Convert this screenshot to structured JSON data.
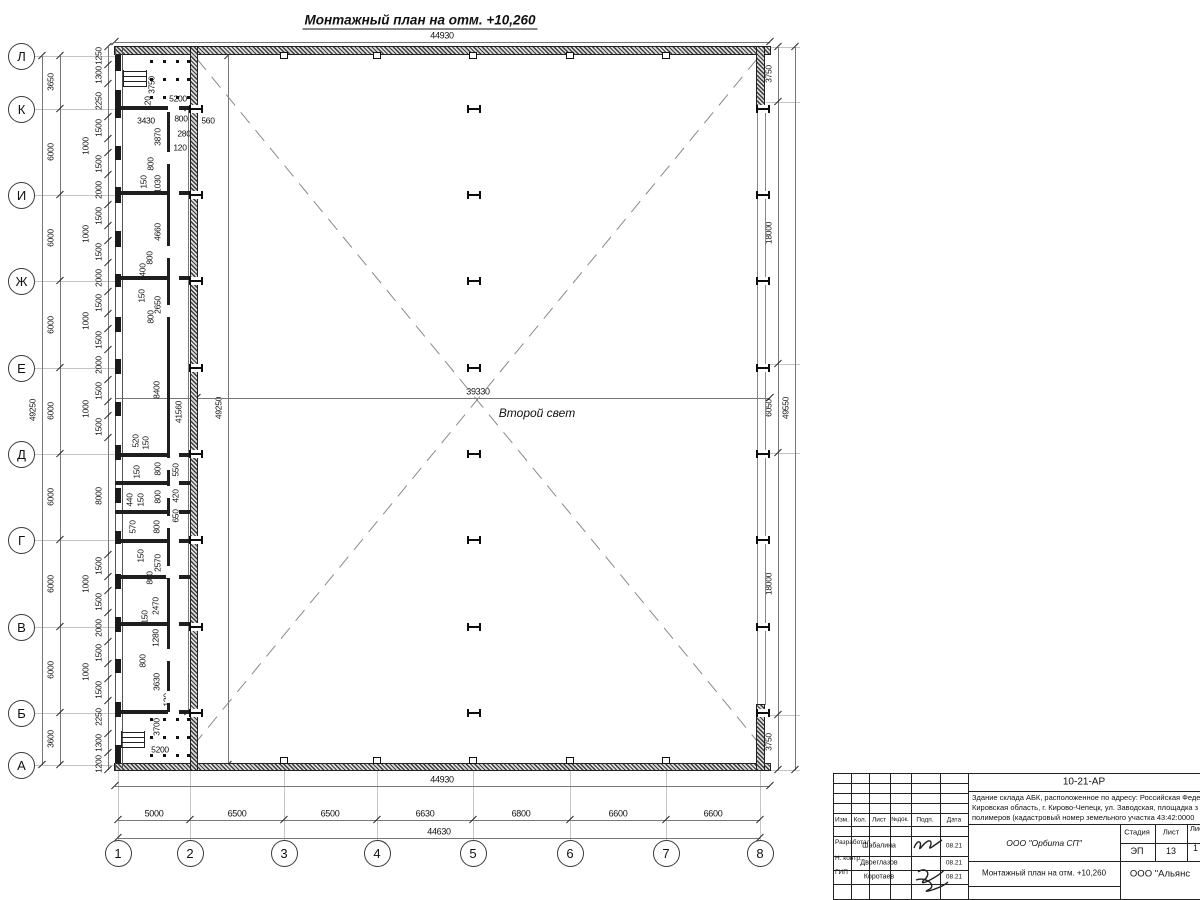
{
  "sheet": {
    "title": "Монтажный план на отм. +10,260",
    "second_light_label": "Второй свет"
  },
  "axis_rows": [
    [
      "Л",
      56
    ],
    [
      "К",
      109
    ],
    [
      "И",
      195
    ],
    [
      "Ж",
      281
    ],
    [
      "Е",
      368
    ],
    [
      "Д",
      454
    ],
    [
      "Г",
      540
    ],
    [
      "В",
      627
    ],
    [
      "Б",
      713
    ],
    [
      "А",
      765
    ]
  ],
  "axis_cols": [
    [
      "1",
      118
    ],
    [
      "2",
      190
    ],
    [
      "3",
      284
    ],
    [
      "4",
      377
    ],
    [
      "5",
      473
    ],
    [
      "6",
      570
    ],
    [
      "7",
      666
    ],
    [
      "8",
      760
    ]
  ],
  "chains": [
    {
      "o": "v",
      "p": 42,
      "a": 56,
      "b": 765,
      "t": [
        56,
        765
      ],
      "l": [
        [
          "49250",
          410,
          0
        ]
      ]
    },
    {
      "o": "v",
      "p": 60,
      "a": 56,
      "b": 765,
      "t": [
        56,
        109,
        195,
        281,
        368,
        454,
        540,
        627,
        713,
        765
      ],
      "l": [
        [
          "3650",
          82,
          0
        ],
        [
          "6000",
          152,
          0
        ],
        [
          "6000",
          238,
          0
        ],
        [
          "6000",
          325,
          0
        ],
        [
          "6000",
          411,
          0
        ],
        [
          "6000",
          497,
          0
        ],
        [
          "6000",
          584,
          0
        ],
        [
          "6000",
          670,
          0
        ],
        [
          "3600",
          739,
          0
        ]
      ]
    },
    {
      "o": "v",
      "p": 108,
      "a": 47,
      "b": 770,
      "t": [
        47,
        65,
        84,
        117,
        139,
        153,
        175,
        205,
        226,
        241,
        263,
        292,
        314,
        329,
        350,
        380,
        402,
        416,
        438,
        555,
        577,
        591,
        613,
        642,
        664,
        679,
        701,
        734,
        753,
        770
      ],
      "l": [
        [
          "1250",
          56,
          0
        ],
        [
          "1300",
          75,
          0
        ],
        [
          "2250",
          101,
          0
        ],
        [
          "1500",
          128,
          0
        ],
        [
          "1000",
          146,
          1
        ],
        [
          "1500",
          164,
          0
        ],
        [
          "2000",
          190,
          0
        ],
        [
          "1500",
          216,
          0
        ],
        [
          "1000",
          234,
          1
        ],
        [
          "1500",
          252,
          0
        ],
        [
          "2000",
          278,
          0
        ],
        [
          "1500",
          303,
          0
        ],
        [
          "1000",
          321,
          1
        ],
        [
          "1500",
          340,
          0
        ],
        [
          "2000",
          365,
          0
        ],
        [
          "1500",
          391,
          0
        ],
        [
          "1000",
          409,
          1
        ],
        [
          "1500",
          427,
          0
        ],
        [
          "8000",
          496,
          0
        ],
        [
          "1500",
          566,
          0
        ],
        [
          "1000",
          584,
          1
        ],
        [
          "1500",
          602,
          0
        ],
        [
          "2000",
          628,
          0
        ],
        [
          "1500",
          653,
          0
        ],
        [
          "1000",
          672,
          1
        ],
        [
          "1500",
          690,
          0
        ],
        [
          "2250",
          717,
          0
        ],
        [
          "1300",
          743,
          0
        ],
        [
          "1200",
          764,
          0
        ]
      ]
    },
    {
      "o": "v",
      "p": 778,
      "a": 47,
      "b": 770,
      "t": [
        47,
        102,
        364,
        453,
        715,
        770
      ],
      "l": [
        [
          "3750",
          74,
          0
        ],
        [
          "18000",
          233,
          0
        ],
        [
          "6050",
          408,
          0
        ],
        [
          "18000",
          584,
          0
        ],
        [
          "3750",
          742,
          0
        ]
      ]
    },
    {
      "o": "v",
      "p": 795,
      "a": 47,
      "b": 770,
      "t": [
        47,
        770
      ],
      "l": [
        [
          "49550",
          408,
          0
        ]
      ]
    },
    {
      "o": "h",
      "p": 42,
      "a": 115,
      "b": 770,
      "t": [
        115,
        770
      ],
      "l": [
        [
          "44930",
          442,
          0
        ]
      ]
    },
    {
      "o": "h",
      "p": 786,
      "a": 115,
      "b": 770,
      "t": [
        115,
        770
      ],
      "l": [
        [
          "44930",
          442,
          0
        ]
      ]
    },
    {
      "o": "h",
      "p": 820,
      "a": 118,
      "b": 760,
      "t": [
        118,
        190,
        284,
        377,
        473,
        570,
        666,
        760
      ],
      "l": [
        [
          "5000",
          154,
          0
        ],
        [
          "6500",
          237,
          0
        ],
        [
          "6500",
          330,
          0
        ],
        [
          "6630",
          425,
          0
        ],
        [
          "6800",
          521,
          0
        ],
        [
          "6600",
          618,
          0
        ],
        [
          "6600",
          713,
          0
        ]
      ]
    },
    {
      "o": "h",
      "p": 838,
      "a": 118,
      "b": 760,
      "t": [
        118,
        760
      ],
      "l": [
        [
          "44630",
          439,
          0
        ]
      ]
    },
    {
      "o": "v",
      "p": 188,
      "a": 108,
      "b": 712,
      "t": [
        108,
        712
      ],
      "l": [
        [
          "41560",
          412,
          0
        ]
      ]
    },
    {
      "o": "v",
      "p": 228,
      "a": 56,
      "b": 765,
      "t": [
        56,
        765
      ],
      "l": [
        [
          "49250",
          408,
          0
        ]
      ]
    },
    {
      "o": "h",
      "p": 398,
      "a": 115,
      "b": 770,
      "t": [
        197,
        770
      ],
      "l": [
        [
          "39330",
          478,
          0
        ]
      ]
    }
  ],
  "labels": [
    [
      "5200",
      178,
      99,
      0
    ],
    [
      "3750",
      152,
      85,
      1
    ],
    [
      "120",
      148,
      103,
      1
    ],
    [
      "3430",
      146,
      121,
      0
    ],
    [
      "800",
      181,
      119,
      0
    ],
    [
      "560",
      208,
      121,
      0
    ],
    [
      "280",
      184,
      134,
      0
    ],
    [
      "120",
      180,
      148,
      0
    ],
    [
      "3870",
      158,
      137,
      1
    ],
    [
      "800",
      151,
      164,
      1
    ],
    [
      "150",
      144,
      182,
      1
    ],
    [
      "1030",
      158,
      184,
      1
    ],
    [
      "4660",
      158,
      232,
      1
    ],
    [
      "800",
      150,
      258,
      1
    ],
    [
      "400",
      143,
      270,
      1
    ],
    [
      "150",
      142,
      296,
      1
    ],
    [
      "2650",
      158,
      305,
      1
    ],
    [
      "800",
      151,
      317,
      1
    ],
    [
      "8400",
      157,
      390,
      1
    ],
    [
      "520",
      136,
      441,
      1
    ],
    [
      "150",
      146,
      443,
      1
    ],
    [
      "150",
      137,
      472,
      1
    ],
    [
      "800",
      158,
      469,
      1
    ],
    [
      "550",
      176,
      470,
      1
    ],
    [
      "440",
      130,
      500,
      1
    ],
    [
      "150",
      141,
      500,
      1
    ],
    [
      "800",
      158,
      497,
      1
    ],
    [
      "420",
      176,
      496,
      1
    ],
    [
      "570",
      133,
      527,
      1
    ],
    [
      "800",
      157,
      527,
      1
    ],
    [
      "650",
      176,
      516,
      1
    ],
    [
      "150",
      141,
      556,
      1
    ],
    [
      "2570",
      158,
      563,
      1
    ],
    [
      "800",
      150,
      578,
      1
    ],
    [
      "2470",
      156,
      606,
      1
    ],
    [
      "150",
      145,
      617,
      1
    ],
    [
      "1280",
      156,
      638,
      1
    ],
    [
      "800",
      143,
      661,
      1
    ],
    [
      "3630",
      157,
      682,
      1
    ],
    [
      "120",
      167,
      700,
      1
    ],
    [
      "3700",
      157,
      727,
      1
    ],
    [
      "5200",
      160,
      750,
      0
    ]
  ],
  "partitions": [
    108,
    193,
    278,
    455,
    483,
    512,
    541,
    577,
    624,
    712
  ],
  "piers": [
    [
      55,
      16
    ],
    [
      90,
      28
    ],
    [
      146,
      14
    ],
    [
      187,
      16
    ],
    [
      231,
      16
    ],
    [
      274,
      13
    ],
    [
      317,
      15
    ],
    [
      359,
      15
    ],
    [
      402,
      14
    ],
    [
      445,
      15
    ],
    [
      488,
      15
    ],
    [
      531,
      13
    ],
    [
      574,
      15
    ],
    [
      617,
      15
    ],
    [
      659,
      14
    ],
    [
      702,
      15
    ],
    [
      745,
      18
    ]
  ],
  "corridor_gaps": [
    158,
    252,
    311,
    464,
    492,
    522,
    572,
    655,
    697
  ],
  "hcols": {
    "xs": [
      194,
      472,
      761
    ],
    "ys": [
      109,
      195,
      281,
      368,
      454,
      540,
      627,
      713
    ]
  },
  "squares": {
    "xs": [
      284,
      377,
      473,
      570,
      666
    ],
    "ytop": 52,
    "ybot": 757
  },
  "dots": {
    "xs": [
      150,
      163,
      176,
      187
    ],
    "ys_top": [
      60,
      78,
      96
    ],
    "ys_bot": [
      718,
      736,
      754
    ]
  },
  "stairs": [
    [
      123,
      70
    ],
    [
      121,
      731
    ]
  ],
  "ext_right": [
    47,
    102,
    364,
    453,
    715,
    770
  ],
  "titleblock": {
    "vlines": [
      [
        833,
        773,
        899
      ],
      [
        851,
        773,
        899
      ],
      [
        869,
        773,
        899
      ],
      [
        890,
        773,
        899
      ],
      [
        911,
        773,
        899
      ],
      [
        940,
        773,
        899
      ],
      [
        968,
        773,
        899
      ],
      [
        1120,
        824,
        899
      ],
      [
        1155,
        824,
        861
      ],
      [
        1187,
        824,
        861
      ]
    ],
    "hlines": [
      [
        773,
        833,
        1200
      ],
      [
        783,
        833,
        968
      ],
      [
        793,
        833,
        968
      ],
      [
        803,
        833,
        968
      ],
      [
        813,
        833,
        968
      ],
      [
        826,
        833,
        968
      ],
      [
        836,
        833,
        968
      ],
      [
        856,
        833,
        968
      ],
      [
        870,
        833,
        968
      ],
      [
        884,
        833,
        968
      ],
      [
        899,
        833,
        1200
      ],
      [
        791,
        968,
        1200
      ],
      [
        824,
        968,
        1200
      ],
      [
        843,
        1120,
        1200
      ],
      [
        861,
        968,
        1200
      ],
      [
        886,
        968,
        1120
      ]
    ],
    "texts": [
      {
        "t": "10-21-АР",
        "x": 1084,
        "y": 782,
        "s": 10,
        "c": 1
      },
      {
        "t": "Здание склада АБК, расположенное по адресу: Российская Феде",
        "x": 972,
        "y": 797,
        "s": 7.5
      },
      {
        "t": "Кировская область, г. Кирово-Чепецк, ул. Заводская, площадка з",
        "x": 972,
        "y": 807,
        "s": 7.5
      },
      {
        "t": "полимеров (кадастровый номер земельного участка 43:42:0000",
        "x": 972,
        "y": 817,
        "s": 7.5
      },
      {
        "t": "Изм.",
        "x": 842,
        "y": 820,
        "s": 6.5,
        "c": 1
      },
      {
        "t": "Кол.",
        "x": 860,
        "y": 820,
        "s": 6.5,
        "c": 1
      },
      {
        "t": "Лист",
        "x": 879,
        "y": 820,
        "s": 6.5,
        "c": 1
      },
      {
        "t": "№док.",
        "x": 900,
        "y": 820,
        "s": 6,
        "c": 1
      },
      {
        "t": "Подп.",
        "x": 925,
        "y": 820,
        "s": 6.5,
        "c": 1
      },
      {
        "t": "Дата",
        "x": 954,
        "y": 820,
        "s": 6.5,
        "c": 1
      },
      {
        "t": "Разработал",
        "x": 835,
        "y": 843,
        "s": 6.5
      },
      {
        "t": "Шабалина",
        "x": 879,
        "y": 846,
        "s": 7,
        "c": 1
      },
      {
        "t": "08.21",
        "x": 954,
        "y": 846,
        "s": 6.5,
        "c": 1
      },
      {
        "t": "Н. контр.",
        "x": 835,
        "y": 859,
        "s": 6.5
      },
      {
        "t": "Двоеглазов",
        "x": 879,
        "y": 863,
        "s": 7,
        "c": 1
      },
      {
        "t": "08.21",
        "x": 954,
        "y": 863,
        "s": 6.5,
        "c": 1
      },
      {
        "t": "ГИП",
        "x": 835,
        "y": 873,
        "s": 6.5
      },
      {
        "t": "Коротаев",
        "x": 879,
        "y": 877,
        "s": 7,
        "c": 1
      },
      {
        "t": "08.21",
        "x": 954,
        "y": 877,
        "s": 6.5,
        "c": 1
      },
      {
        "t": "Стадия",
        "x": 1137,
        "y": 832,
        "s": 7.5,
        "c": 1
      },
      {
        "t": "Лист",
        "x": 1171,
        "y": 832,
        "s": 7.5,
        "c": 1
      },
      {
        "t": "Листов",
        "x": 1190,
        "y": 828,
        "s": 7.5
      },
      {
        "t": "ЭП",
        "x": 1137,
        "y": 851,
        "s": 9,
        "c": 1
      },
      {
        "t": "13",
        "x": 1171,
        "y": 851,
        "s": 9,
        "c": 1
      },
      {
        "t": "1",
        "x": 1193,
        "y": 847,
        "s": 9
      },
      {
        "t": "ООО \"Орбита СП\"",
        "x": 1044,
        "y": 843,
        "s": 8.5,
        "c": 1,
        "i": 1
      },
      {
        "t": "Монтажный план на отм. +10,260",
        "x": 1044,
        "y": 873,
        "s": 8,
        "c": 1
      },
      {
        "t": "ООО \"Альянс",
        "x": 1160,
        "y": 874,
        "s": 9.5,
        "c": 1
      }
    ]
  }
}
